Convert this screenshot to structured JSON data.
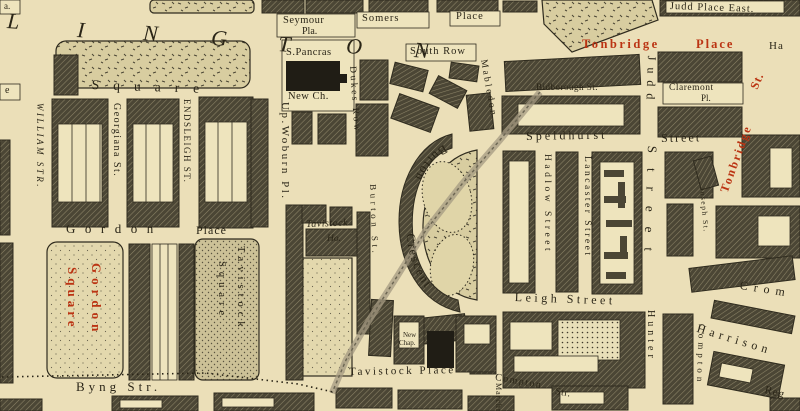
{
  "palette": {
    "paper": "#ebdfb8",
    "ink": "#2a2517",
    "red": "#bb3413",
    "block": "#4b4635",
    "hatch_line": "#8d8568",
    "garden": "#d8cda0",
    "stipple_dark": "#ccc197",
    "stipple_light": "#e3d8ad",
    "building_black": "#201d15"
  },
  "crescent": {
    "upper": "Burton",
    "lower": "Crescent"
  },
  "labels": [
    {
      "name": "fragment-top-left",
      "text": "a.",
      "x": 4,
      "y": 2,
      "size": 9,
      "rot": 0,
      "sp": 0,
      "italic": 0,
      "bold": 0,
      "color": "ink"
    },
    {
      "name": "road-letter-l",
      "text": "L",
      "x": 8,
      "y": 10,
      "size": 22,
      "rot": 4,
      "sp": 0,
      "italic": 1,
      "bold": 0,
      "color": "ink"
    },
    {
      "name": "road-letter-i",
      "text": "I",
      "x": 78,
      "y": 19,
      "size": 22,
      "rot": 4,
      "sp": 0,
      "italic": 1,
      "bold": 0,
      "color": "ink"
    },
    {
      "name": "road-letter-n1",
      "text": "N",
      "x": 144,
      "y": 22,
      "size": 22,
      "rot": 4,
      "sp": 0,
      "italic": 1,
      "bold": 0,
      "color": "ink"
    },
    {
      "name": "road-letter-g",
      "text": "G",
      "x": 212,
      "y": 27,
      "size": 22,
      "rot": 4,
      "sp": 0,
      "italic": 1,
      "bold": 0,
      "color": "ink"
    },
    {
      "name": "road-letter-t",
      "text": "T",
      "x": 279,
      "y": 33,
      "size": 22,
      "rot": 4,
      "sp": 0,
      "italic": 1,
      "bold": 0,
      "color": "ink"
    },
    {
      "name": "road-letter-o",
      "text": "O",
      "x": 347,
      "y": 35,
      "size": 22,
      "rot": 4,
      "sp": 0,
      "italic": 1,
      "bold": 0,
      "color": "ink"
    },
    {
      "name": "road-letter-n2",
      "text": "N",
      "x": 415,
      "y": 39,
      "size": 22,
      "rot": 4,
      "sp": 0,
      "italic": 1,
      "bold": 0,
      "color": "ink"
    },
    {
      "name": "seymour-place-label",
      "text": "Seymour",
      "x": 283,
      "y": 16,
      "size": 10.5,
      "rot": 0,
      "sp": 0.5,
      "italic": 0,
      "bold": 0,
      "color": "ink"
    },
    {
      "name": "seymour-place-label-2",
      "text": "Pla.",
      "x": 302,
      "y": 27,
      "size": 10,
      "rot": 0,
      "sp": 0,
      "italic": 0,
      "bold": 0,
      "color": "ink"
    },
    {
      "name": "somers-place-label",
      "text": "Somers",
      "x": 362,
      "y": 14,
      "size": 10.5,
      "rot": 0,
      "sp": 1,
      "italic": 0,
      "bold": 0,
      "color": "ink"
    },
    {
      "name": "somers-place-label-2",
      "text": "Place",
      "x": 456,
      "y": 12,
      "size": 10.5,
      "rot": 0,
      "sp": 1,
      "italic": 0,
      "bold": 0,
      "color": "ink"
    },
    {
      "name": "judd-place-east-label",
      "text": "Judd Place East.",
      "x": 670,
      "y": 2,
      "size": 10.5,
      "rot": 2,
      "sp": 1,
      "italic": 0,
      "bold": 0,
      "color": "ink"
    },
    {
      "name": "tonbridge-place-label",
      "text": "Tonbridge",
      "x": 582,
      "y": 38,
      "size": 12.5,
      "rot": 0,
      "sp": 2.5,
      "italic": 0,
      "bold": 1,
      "color": "red"
    },
    {
      "name": "tonbridge-place-label-2",
      "text": "Place",
      "x": 696,
      "y": 38,
      "size": 12.5,
      "rot": 0,
      "sp": 2,
      "italic": 0,
      "bold": 1,
      "color": "red"
    },
    {
      "name": "fragment-ha",
      "text": "Ha",
      "x": 769,
      "y": 41,
      "size": 11,
      "rot": 0,
      "sp": 1,
      "italic": 0,
      "bold": 0,
      "color": "ink"
    },
    {
      "name": "south-row-label",
      "text": "South Row",
      "x": 410,
      "y": 47,
      "size": 10.5,
      "rot": 0,
      "sp": 1,
      "italic": 0,
      "bold": 0,
      "color": "ink"
    },
    {
      "name": "st-pancras-label",
      "text": "S.Pancras",
      "x": 286,
      "y": 48,
      "size": 10.5,
      "rot": 0,
      "sp": 0.5,
      "italic": 0,
      "bold": 0,
      "color": "ink"
    },
    {
      "name": "new-church-label",
      "text": "New Ch.",
      "x": 288,
      "y": 92,
      "size": 10.5,
      "rot": 0,
      "sp": 0.5,
      "italic": 0,
      "bold": 0,
      "color": "ink"
    },
    {
      "name": "euston-square-label",
      "text": "Square",
      "x": 92,
      "y": 78,
      "size": 13.5,
      "rot": 2,
      "sp": 14,
      "italic": 0,
      "bold": 0,
      "color": "ink"
    },
    {
      "name": "fragment-e",
      "text": "e",
      "x": 5,
      "y": 86,
      "size": 10,
      "rot": 0,
      "sp": 0,
      "italic": 0,
      "bold": 0,
      "color": "ink"
    },
    {
      "name": "bidborough-st-label",
      "text": "Bidborough St.",
      "x": 536,
      "y": 83,
      "size": 9,
      "rot": 0,
      "sp": 0.5,
      "italic": 0,
      "bold": 0,
      "color": "ink"
    },
    {
      "name": "claremont-pl-label",
      "text": "Claremont",
      "x": 669,
      "y": 84,
      "size": 9.5,
      "rot": 0,
      "sp": 0.5,
      "italic": 0,
      "bold": 0,
      "color": "ink"
    },
    {
      "name": "claremont-pl-label-2",
      "text": "Pl.",
      "x": 701,
      "y": 94,
      "size": 9,
      "rot": 0,
      "sp": 0,
      "italic": 0,
      "bold": 0,
      "color": "ink"
    },
    {
      "name": "tonbridge-st-label",
      "text": "Tonbridge",
      "x": 718,
      "y": 190,
      "size": 12,
      "rot": -70,
      "sp": 2,
      "italic": 0,
      "bold": 1,
      "color": "red"
    },
    {
      "name": "tonbridge-st-label-2",
      "text": "St.",
      "x": 748,
      "y": 86,
      "size": 12,
      "rot": -66,
      "sp": 1,
      "italic": 0,
      "bold": 1,
      "color": "red"
    },
    {
      "name": "speldhurst-street-label",
      "text": "Speldhurst",
      "x": 526,
      "y": 130,
      "size": 12,
      "rot": -1,
      "sp": 3,
      "italic": 0,
      "bold": 0,
      "color": "ink"
    },
    {
      "name": "speldhurst-street-label-2",
      "text": "Street",
      "x": 661,
      "y": 132,
      "size": 12,
      "rot": -1,
      "sp": 2,
      "italic": 0,
      "bold": 0,
      "color": "ink"
    },
    {
      "name": "william-str-label",
      "text": "WILLIAM STR.",
      "x": 44,
      "y": 103,
      "size": 9,
      "rot": 90,
      "sp": 2.5,
      "italic": 1,
      "bold": 0,
      "color": "ink"
    },
    {
      "name": "georgiana-st-label",
      "text": "Georgiana St.",
      "x": 121,
      "y": 103,
      "size": 10,
      "rot": 90,
      "sp": 1.5,
      "italic": 0,
      "bold": 0,
      "color": "ink"
    },
    {
      "name": "endsleigh-st-label",
      "text": "ENDSLEIGH ST.",
      "x": 191,
      "y": 99,
      "size": 9,
      "rot": 90,
      "sp": 1.5,
      "italic": 0,
      "bold": 0,
      "color": "ink"
    },
    {
      "name": "up-woburn-pl-label",
      "text": "Up.Woburn Pl.",
      "x": 290,
      "y": 102,
      "size": 11,
      "rot": 90,
      "sp": 2.5,
      "italic": 0,
      "bold": 0,
      "color": "ink"
    },
    {
      "name": "dukes-row-label",
      "text": "Dukes Row",
      "x": 356,
      "y": 66,
      "size": 9.5,
      "rot": 86,
      "sp": 2.5,
      "italic": 0,
      "bold": 0,
      "color": "ink"
    },
    {
      "name": "mabledon-pl-label",
      "text": "Mabledon",
      "x": 487,
      "y": 59,
      "size": 9.5,
      "rot": 80,
      "sp": 2.5,
      "italic": 0,
      "bold": 0,
      "color": "ink"
    },
    {
      "name": "judd-street-label",
      "text": "Judd",
      "x": 658,
      "y": 56,
      "size": 12,
      "rot": 92,
      "sp": 7,
      "italic": 0,
      "bold": 0,
      "color": "ink"
    },
    {
      "name": "judd-street-label-2",
      "text": "Street",
      "x": 659,
      "y": 146,
      "size": 13,
      "rot": 92,
      "sp": 15,
      "italic": 0,
      "bold": 0,
      "color": "ink"
    },
    {
      "name": "hadlow-street-label",
      "text": "Hadlow Street",
      "x": 551,
      "y": 154,
      "size": 9.5,
      "rot": 90,
      "sp": 3.5,
      "italic": 0,
      "bold": 0,
      "color": "ink"
    },
    {
      "name": "lancaster-street-label",
      "text": "Lancaster Street",
      "x": 591,
      "y": 156,
      "size": 9.5,
      "rot": 90,
      "sp": 2.5,
      "italic": 0,
      "bold": 0,
      "color": "ink"
    },
    {
      "name": "joseph-st-label",
      "text": "Joseph St.",
      "x": 706,
      "y": 187,
      "size": 7.5,
      "rot": 85,
      "sp": 1.5,
      "italic": 0,
      "bold": 0,
      "color": "ink"
    },
    {
      "name": "burton-st-label",
      "text": "Burton St.",
      "x": 377,
      "y": 184,
      "size": 9,
      "rot": 88,
      "sp": 3.5,
      "italic": 0,
      "bold": 0,
      "color": "ink"
    },
    {
      "name": "gordon-place-label",
      "text": "Gordon",
      "x": 66,
      "y": 222,
      "size": 13,
      "rot": 0,
      "sp": 9.5,
      "italic": 0,
      "bold": 0,
      "color": "ink"
    },
    {
      "name": "gordon-place-label-2",
      "text": "Place",
      "x": 196,
      "y": 224,
      "size": 12,
      "rot": 0,
      "sp": 1,
      "italic": 0,
      "bold": 0,
      "color": "ink"
    },
    {
      "name": "tavistock-house-label",
      "text": "Tavistock",
      "x": 306,
      "y": 220,
      "size": 10,
      "rot": -2,
      "sp": 0.5,
      "italic": 1,
      "bold": 0,
      "color": "ink"
    },
    {
      "name": "tavistock-house-label-2",
      "text": "Ho.",
      "x": 327,
      "y": 235,
      "size": 9.5,
      "rot": 0,
      "sp": 0,
      "italic": 1,
      "bold": 0,
      "color": "ink"
    },
    {
      "name": "gordon-square-label",
      "text": "Gordon",
      "x": 103,
      "y": 263,
      "size": 13,
      "rot": 90,
      "sp": 5,
      "italic": 0,
      "bold": 1,
      "color": "red"
    },
    {
      "name": "gordon-square-label-2",
      "text": "Square",
      "x": 79,
      "y": 267,
      "size": 13,
      "rot": 90,
      "sp": 4,
      "italic": 0,
      "bold": 1,
      "color": "red"
    },
    {
      "name": "tavistock-square-label",
      "text": "Tavistock",
      "x": 245,
      "y": 246,
      "size": 10.5,
      "rot": 90,
      "sp": 5,
      "italic": 0,
      "bold": 0,
      "color": "ink"
    },
    {
      "name": "tavistock-square-label-2",
      "text": "Square",
      "x": 226,
      "y": 261,
      "size": 10.5,
      "rot": 90,
      "sp": 5,
      "italic": 0,
      "bold": 0,
      "color": "ink"
    },
    {
      "name": "leigh-street-label",
      "text": "Leigh Street",
      "x": 515,
      "y": 291,
      "size": 12,
      "rot": 2,
      "sp": 3.5,
      "italic": 0,
      "bold": 0,
      "color": "ink"
    },
    {
      "name": "hunter-street-label",
      "text": "Hunter",
      "x": 655,
      "y": 310,
      "size": 10,
      "rot": 90,
      "sp": 4,
      "italic": 0,
      "bold": 0,
      "color": "ink"
    },
    {
      "name": "compton-pl-label",
      "text": "Compton",
      "x": 706,
      "y": 324,
      "size": 9,
      "rot": 92,
      "sp": 4,
      "italic": 0,
      "bold": 0,
      "color": "ink"
    },
    {
      "name": "harrison-st-label",
      "text": "Harrison",
      "x": 699,
      "y": 322,
      "size": 12,
      "rot": 17,
      "sp": 4.5,
      "italic": 0,
      "bold": 0,
      "color": "ink"
    },
    {
      "name": "cromer-st-label",
      "text": "Crom",
      "x": 741,
      "y": 279,
      "size": 12,
      "rot": 9,
      "sp": 6,
      "italic": 0,
      "bold": 0,
      "color": "ink"
    },
    {
      "name": "compton-str-label",
      "text": "Compton",
      "x": 496,
      "y": 373,
      "size": 10,
      "rot": 10,
      "sp": 1.5,
      "italic": 0,
      "bold": 0,
      "color": "ink"
    },
    {
      "name": "compton-str-label-2",
      "text": "Str.",
      "x": 556,
      "y": 387,
      "size": 10,
      "rot": 10,
      "sp": 0.5,
      "italic": 0,
      "bold": 0,
      "color": "ink"
    },
    {
      "name": "tavistock-place-label",
      "text": "Tavistock Place",
      "x": 349,
      "y": 367,
      "size": 11,
      "rot": -1,
      "sp": 2.5,
      "italic": 0,
      "bold": 0,
      "color": "ink"
    },
    {
      "name": "new-chapel-label",
      "text": "New",
      "x": 403,
      "y": 332,
      "size": 7,
      "rot": 0,
      "sp": 0,
      "italic": 0,
      "bold": 0,
      "color": "ink"
    },
    {
      "name": "new-chapel-label-2",
      "text": "Chap.",
      "x": 399,
      "y": 340,
      "size": 7,
      "rot": 0,
      "sp": 0,
      "italic": 0,
      "bold": 0,
      "color": "ink"
    },
    {
      "name": "byng-str-label",
      "text": "Byng Str.",
      "x": 76,
      "y": 380,
      "size": 13,
      "rot": 0,
      "sp": 4,
      "italic": 0,
      "bold": 0,
      "color": "ink"
    },
    {
      "name": "marchmont-st-label",
      "text": "Marchmont",
      "x": 502,
      "y": 383,
      "size": 8,
      "rot": 90,
      "sp": 1,
      "italic": 0,
      "bold": 0,
      "color": "ink"
    },
    {
      "name": "regent-square-fragment",
      "text": "Reg",
      "x": 766,
      "y": 385,
      "size": 11,
      "rot": 14,
      "sp": 1,
      "italic": 0,
      "bold": 0,
      "color": "ink"
    }
  ]
}
